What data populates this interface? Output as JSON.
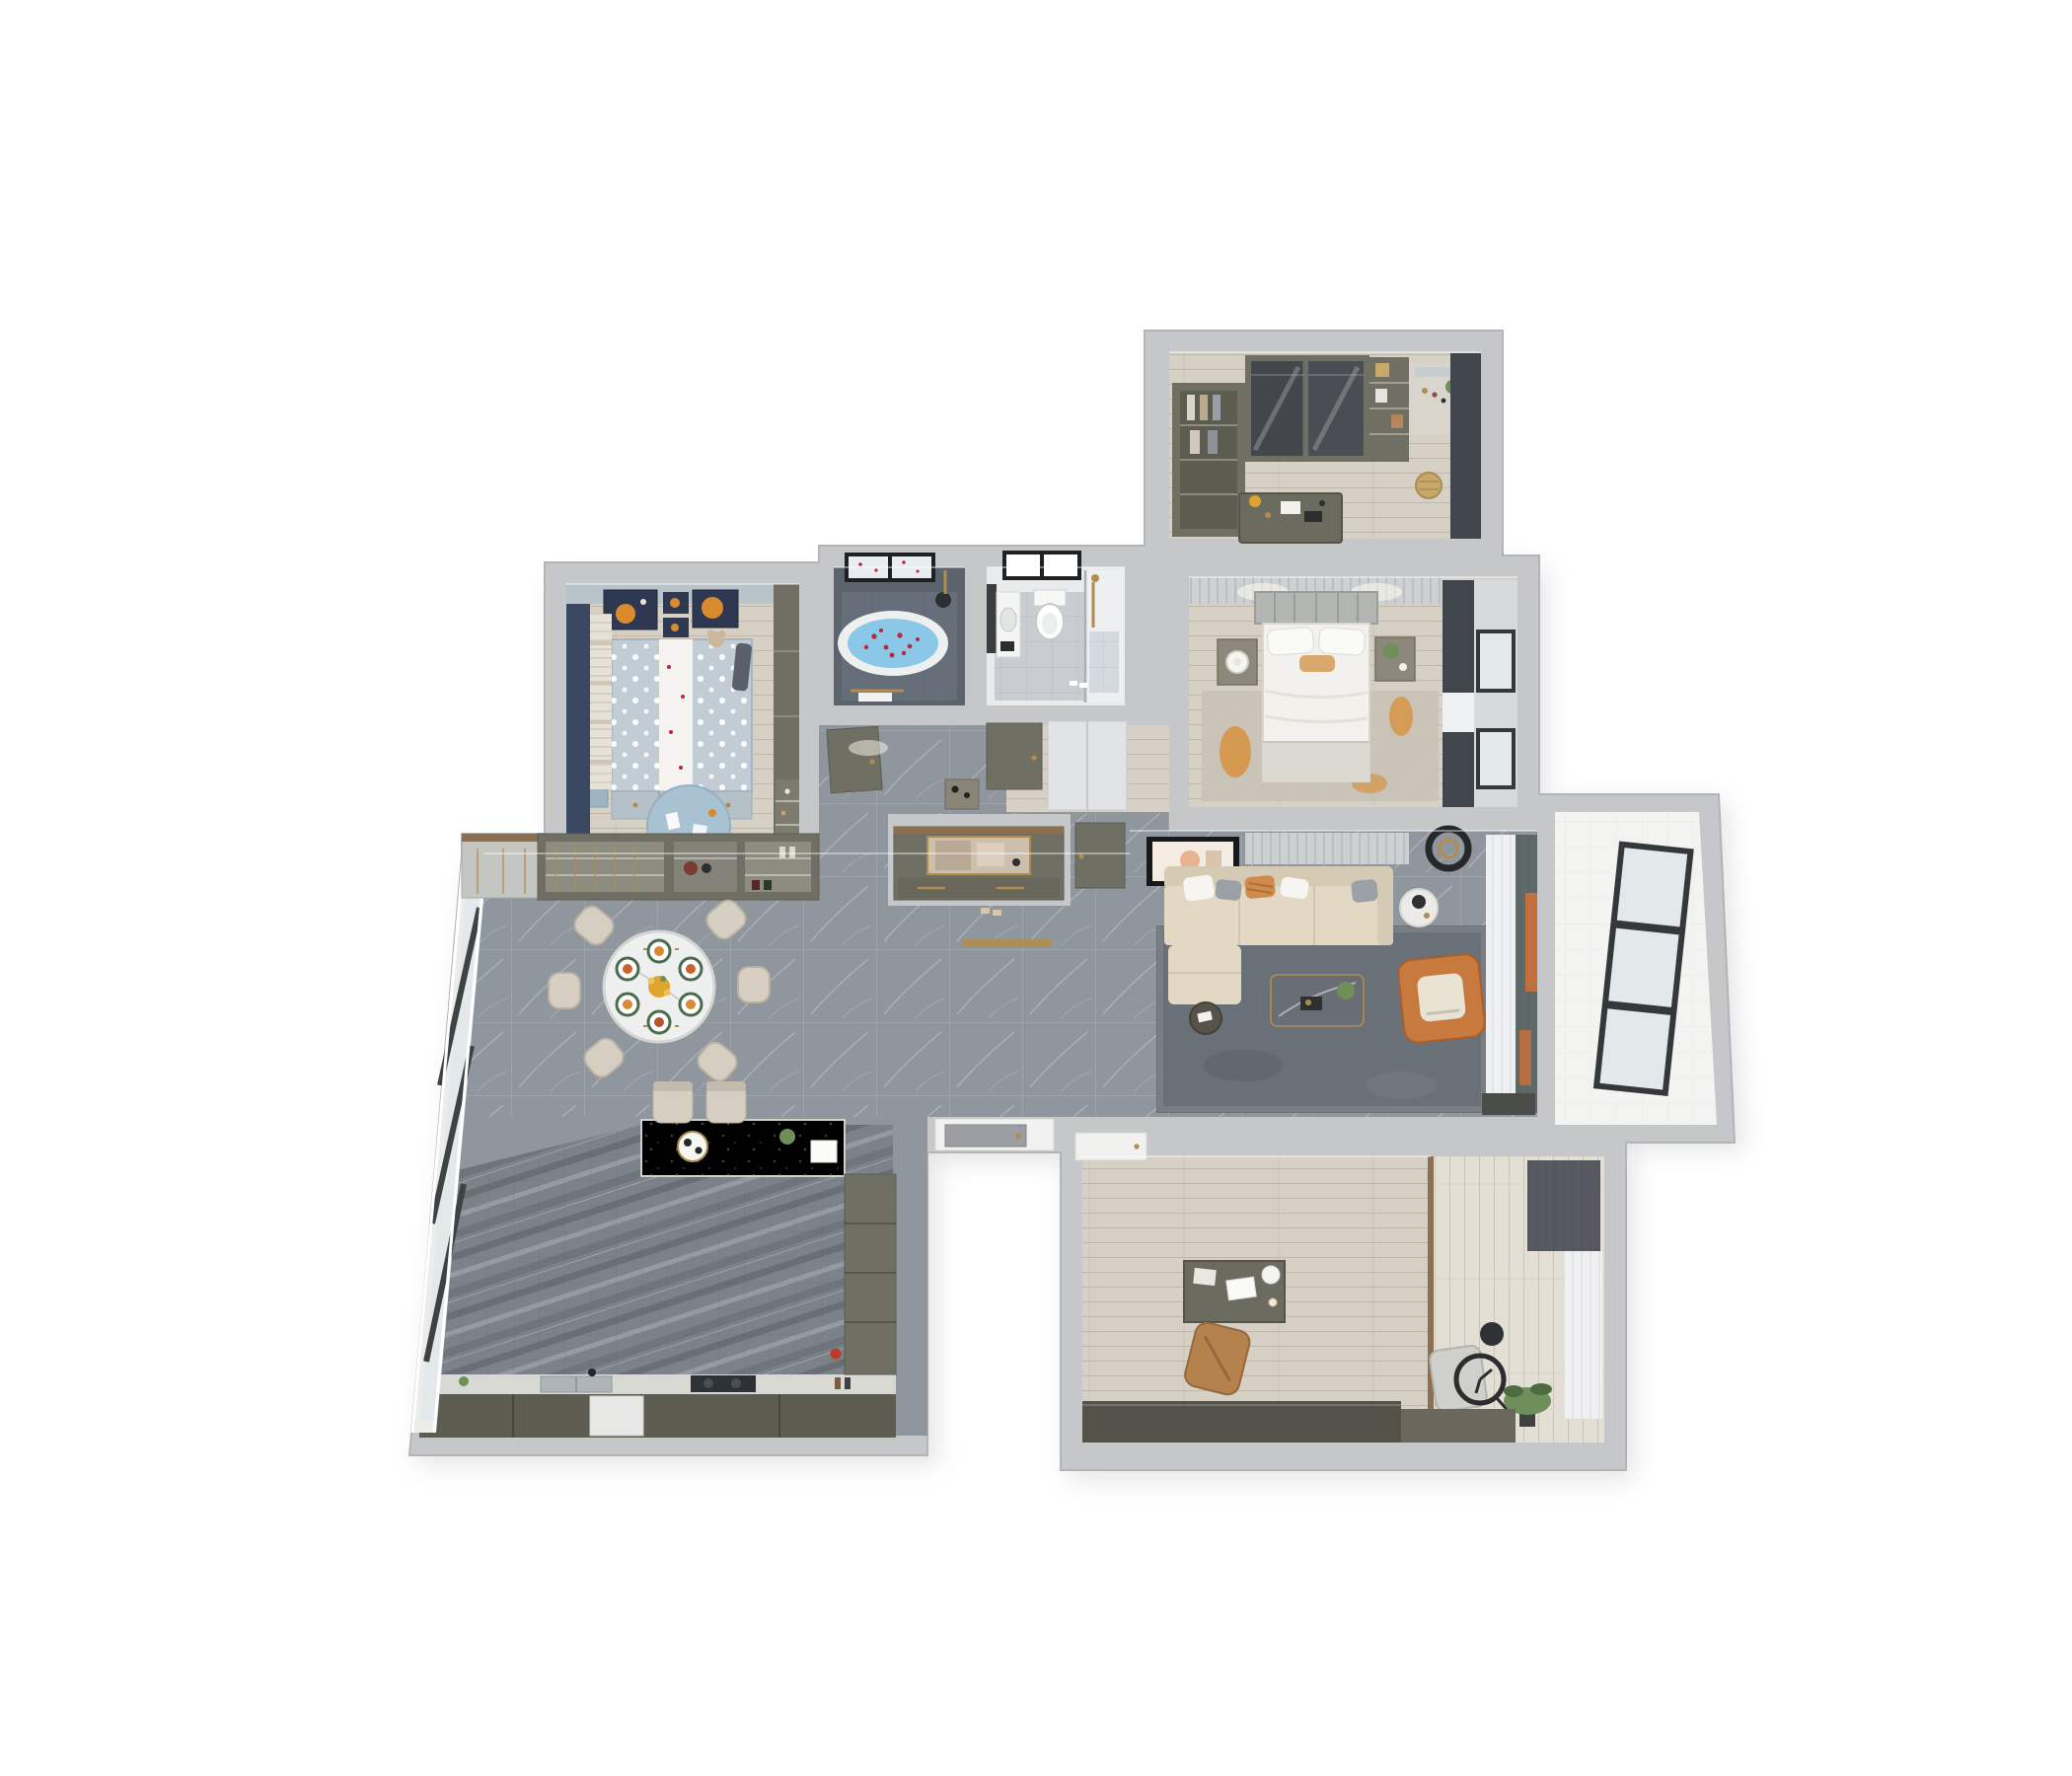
{
  "meta": {
    "description": "Photorealistic top-down 3D cutaway floor plan rendering of a furnished apartment on a white background",
    "view": "top-down axonometric dollhouse view",
    "background": "#ffffff",
    "visible_text": ""
  },
  "palette": {
    "wall": "#c6c7c9",
    "wall-edge": "#b2b4b7",
    "wall-face": "#e0e1e3",
    "marble": "#8f969d",
    "marble-dark": "#7c828a",
    "wood": "#d7d1c5",
    "wood-light": "#e4dfd5",
    "white-floor": "#f3f3f1",
    "olive": "#6f6f63",
    "olive-dark": "#5c5c51",
    "sideboard": "#55524a",
    "sofa": "#e2d8c4",
    "sofa-back": "#d5cab4",
    "orange": "#c8793d",
    "orange-soft": "#d98b2e",
    "rug-living": "#697077",
    "rug-master": "#c9c3b8",
    "rug-kids": "#a8c2d2",
    "kids-bed": "#c2ccd4",
    "kids-wall": "#b9c3ca",
    "navy": "#3a4864",
    "navy-frame": "#2e3850",
    "bath-dark": "#5b636d",
    "bath-dark-floor": "#666f79",
    "water": "#8bc7e6",
    "red": "#b8273b",
    "bath-floor": "#c9cdd1",
    "white": "#f4f4f1",
    "gold": "#b08d4f",
    "curtain-dark": "#41464d",
    "curtain-teal": "#5f6a68",
    "sheer": "#eef0f2",
    "frame-dark": "#35383b",
    "glass": "#e3e8ea",
    "table-white": "#eef0ef",
    "chair-beige": "#d5cec1",
    "desk-olive": "#6b6b5f",
    "green": "#6f8f5a",
    "green-dark": "#4f6b3f",
    "wood-trim": "#8a6f52",
    "dark": "#2c2e30",
    "steel": "#9b9ea2",
    "blue-desk": "#9db3c2",
    "mirror": "#c7ccd1",
    "appliance": "#2e3237",
    "counter": "#d9d9d3"
  },
  "rooms": [
    {
      "id": "walk-in-closet",
      "label": "walk-in closet / dressing room",
      "floor": "light wood plank",
      "furniture": [
        "open wardrobe with clothes",
        "sliding glass wardrobe",
        "shelf unit with bags",
        "dressing table with mirror and plant",
        "rattan basket",
        "center desk island with decor",
        "dark gray curtains"
      ]
    },
    {
      "id": "master-bedroom",
      "label": "master bedroom",
      "floor": "light wood plank",
      "furniture": [
        "double bed with white duvet",
        "paneled headboard",
        "orange lumbar pillow",
        "two nightstands",
        "round table lamp",
        "potted plant",
        "distressed gray-orange area rug",
        "charcoal curtains with windows",
        "slatted feature wall"
      ]
    },
    {
      "id": "bathroom-tub",
      "label": "bathroom with bathtub",
      "floor": "dark slate tile",
      "furniture": [
        "oval freestanding bathtub with blue water and red petals",
        "black framed window",
        "brass shower fixture",
        "towel rail"
      ]
    },
    {
      "id": "bathroom-shower",
      "label": "shower bathroom",
      "floor": "light marble tile",
      "furniture": [
        "wall-hung toilet",
        "vanity with sink",
        "dark mirror cabinet",
        "glass shower enclosure with brass fittings",
        "black framed window",
        "slippers"
      ]
    },
    {
      "id": "kids-bedroom",
      "label": "kids bedroom",
      "floor": "light wood plank",
      "furniture": [
        "bed with polka-dot bedding and white runner",
        "teddy bear",
        "under-bed drawers",
        "blue desk",
        "wardrobe with open shelving",
        "round blue play rug",
        "navy curtains and striped blind",
        "space-themed wall art with orange planets"
      ]
    },
    {
      "id": "dining-room",
      "label": "dining room",
      "floor": "gray marble tile",
      "furniture": [
        "round marble dining table",
        "six beige chairs",
        "six place settings with green-rim plates",
        "yellow flower centerpiece",
        "wine and display sideboard with brass racks"
      ]
    },
    {
      "id": "kitchen",
      "label": "open kitchen",
      "floor": "dark veined marble tile",
      "furniture": [
        "island bar with white terrazzo top",
        "two bar stools",
        "serving tray with cups",
        "counter run with sink, faucet and black cooktop",
        "tall pantry cabinet",
        "white appliance front",
        "floor-to-ceiling windows on slanted wall"
      ]
    },
    {
      "id": "entry-foyer",
      "label": "entry foyer and hallway",
      "floor": "gray marble tile",
      "furniture": [
        "built-in shoe cabinet with mirrored niche",
        "brass door threshold",
        "console table",
        "interior doors with brass handles",
        "white linen closet"
      ]
    },
    {
      "id": "living-room",
      "label": "living room",
      "floor": "gray marble tile",
      "furniture": [
        "beige L-shaped sectional sofa",
        "assorted pillows",
        "dark marble coffee table with plant",
        "orange leather armchair with white cushion",
        "round white side table with lamp",
        "round dark side table",
        "large dark gray rug",
        "leaning framed artwork",
        "black ring ceiling light",
        "teal and orange curtains with sheers"
      ]
    },
    {
      "id": "balcony",
      "label": "balcony off living room",
      "floor": "white tile",
      "furniture": [
        "dark framed three-pane window unit"
      ]
    },
    {
      "id": "study",
      "label": "study / home office",
      "floor": "light wood plank with balcony strip",
      "furniture": [
        "olive desk with laptop and lamp",
        "tan leather office chair",
        "gray lounge chair",
        "floor clock with black ring",
        "round dark side table",
        "potted plant",
        "long dark sideboard",
        "white door",
        "gray curtain and sheers"
      ]
    }
  ]
}
